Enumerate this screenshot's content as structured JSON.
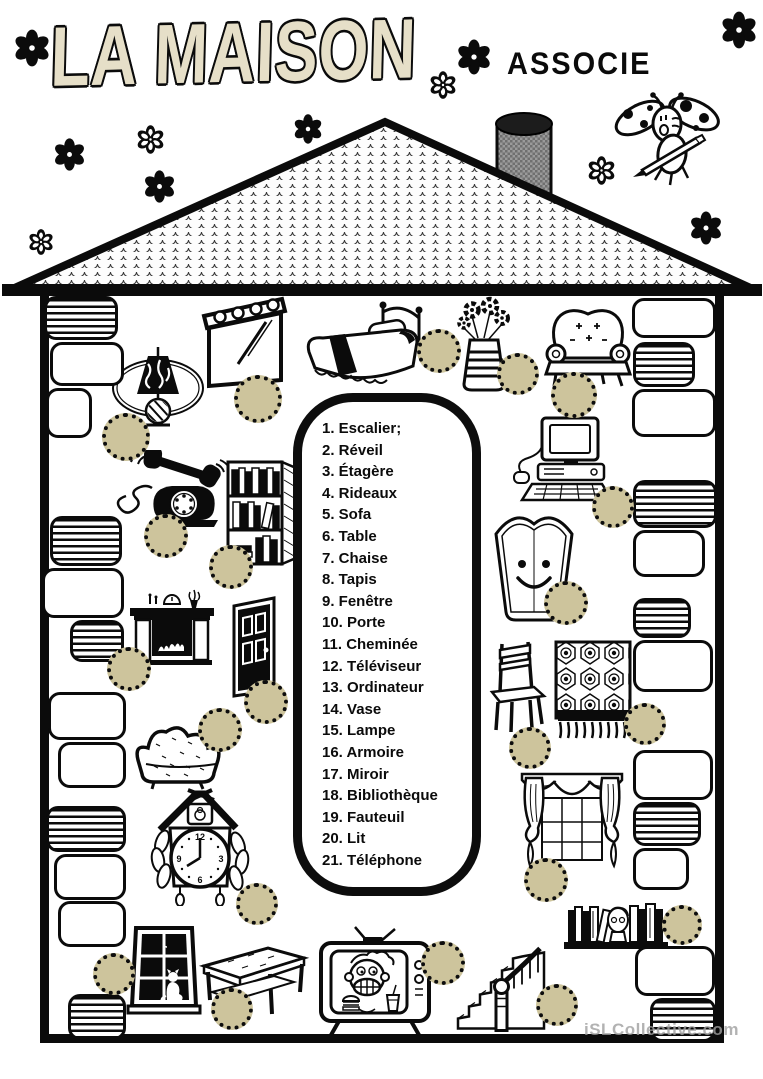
{
  "header": {
    "title": "LA MAISON",
    "instruction": "ASSOCIE"
  },
  "list": {
    "items": [
      {
        "n": 1,
        "label": "Escalier;"
      },
      {
        "n": 2,
        "label": "Réveil"
      },
      {
        "n": 3,
        "label": "Étagère"
      },
      {
        "n": 4,
        "label": "Rideaux"
      },
      {
        "n": 5,
        "label": "Sofa"
      },
      {
        "n": 6,
        "label": "Table"
      },
      {
        "n": 7,
        "label": "Chaise"
      },
      {
        "n": 8,
        "label": "Tapis"
      },
      {
        "n": 9,
        "label": "Fenêtre"
      },
      {
        "n": 10,
        "label": "Porte"
      },
      {
        "n": 11,
        "label": "Cheminée"
      },
      {
        "n": 12,
        "label": "Téléviseur"
      },
      {
        "n": 13,
        "label": "Ordinateur"
      },
      {
        "n": 14,
        "label": "Vase"
      },
      {
        "n": 15,
        "label": "Lampe"
      },
      {
        "n": 16,
        "label": "Armoire"
      },
      {
        "n": 17,
        "label": "Miroir"
      },
      {
        "n": 18,
        "label": "Bibliothèque"
      },
      {
        "n": 19,
        "label": "Fauteuil"
      },
      {
        "n": 20,
        "label": "Lit"
      },
      {
        "n": 21,
        "label": "Téléphone"
      }
    ]
  },
  "footer": {
    "watermark": "iSLCollective.com"
  },
  "colors": {
    "ink": "#0b0b0b",
    "answer_circle_fill": "#cdc49c",
    "title_fill": "#e6dfc8",
    "watermark": "#9f9f9f"
  },
  "icons": {
    "flower": "flower-icon",
    "ladybug": "ladybug-mascot-icon"
  },
  "illustrations": [
    "lamp",
    "window",
    "bed",
    "flower-vase",
    "armchair",
    "telephone",
    "bookshelf",
    "computer",
    "mirror",
    "fireplace",
    "door",
    "sofa",
    "chair",
    "rug",
    "cuckoo-clock",
    "curtains",
    "window-with-cat",
    "table",
    "television",
    "staircase",
    "bookcase-with-bust"
  ]
}
